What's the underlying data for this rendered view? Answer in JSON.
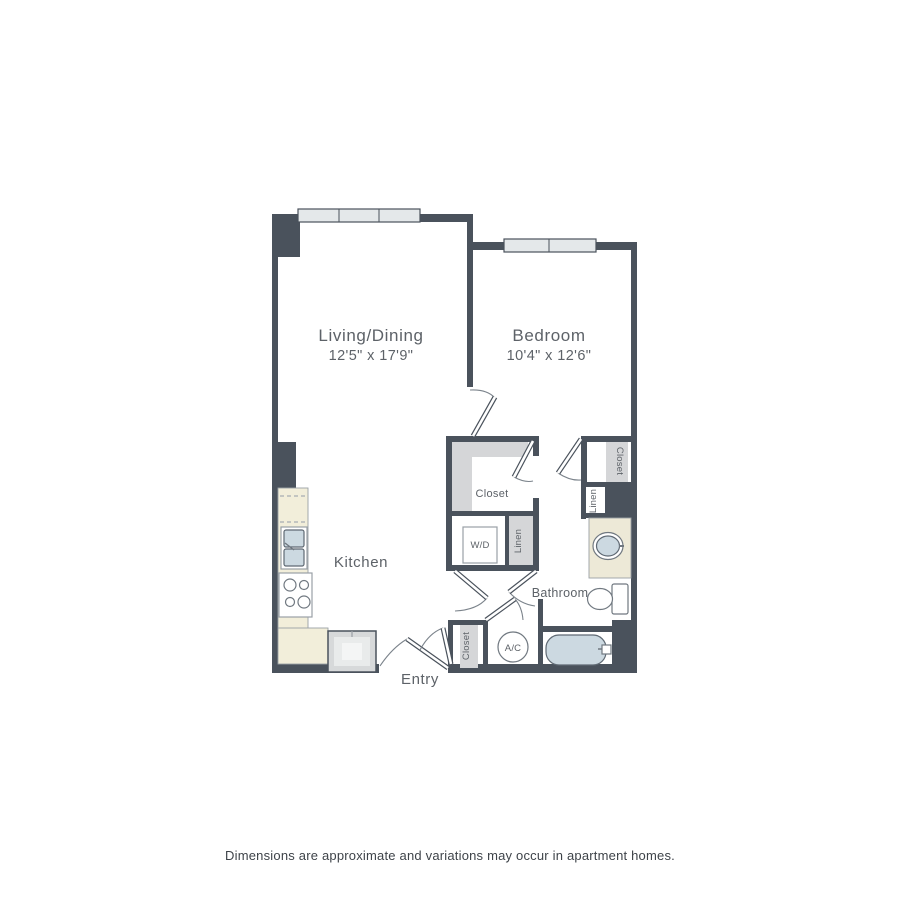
{
  "floor_plan": {
    "living_dining": {
      "label": "Living/Dining",
      "dimensions": "12'5\" x 17'9\""
    },
    "bedroom": {
      "label": "Bedroom",
      "dimensions": "10'4\" x 12'6\""
    },
    "kitchen": {
      "label": "Kitchen"
    },
    "bathroom": {
      "label": "Bathroom"
    },
    "entry": {
      "label": "Entry"
    },
    "walkin_closet": {
      "label": "Closet"
    },
    "washer_dryer": {
      "label": "W/D"
    },
    "linen_center": {
      "label": "Linen"
    },
    "linen_bath": {
      "label": "Linen"
    },
    "bedroom_closet": {
      "label": "Closet"
    },
    "entry_closet": {
      "label": "Closet"
    },
    "ac_unit": {
      "label": "A/C"
    },
    "colors": {
      "wall": "#4a525c",
      "window": "#e4e8ea",
      "counter": "#f2eeda",
      "vanity": "#ede9d7",
      "fixture_blue": "#ccd9e1",
      "closet_shading": "#d5d6d8",
      "label_text": "#5d6268"
    }
  },
  "footer": {
    "disclaimer": "Dimensions are approximate and variations may occur in apartment homes."
  }
}
